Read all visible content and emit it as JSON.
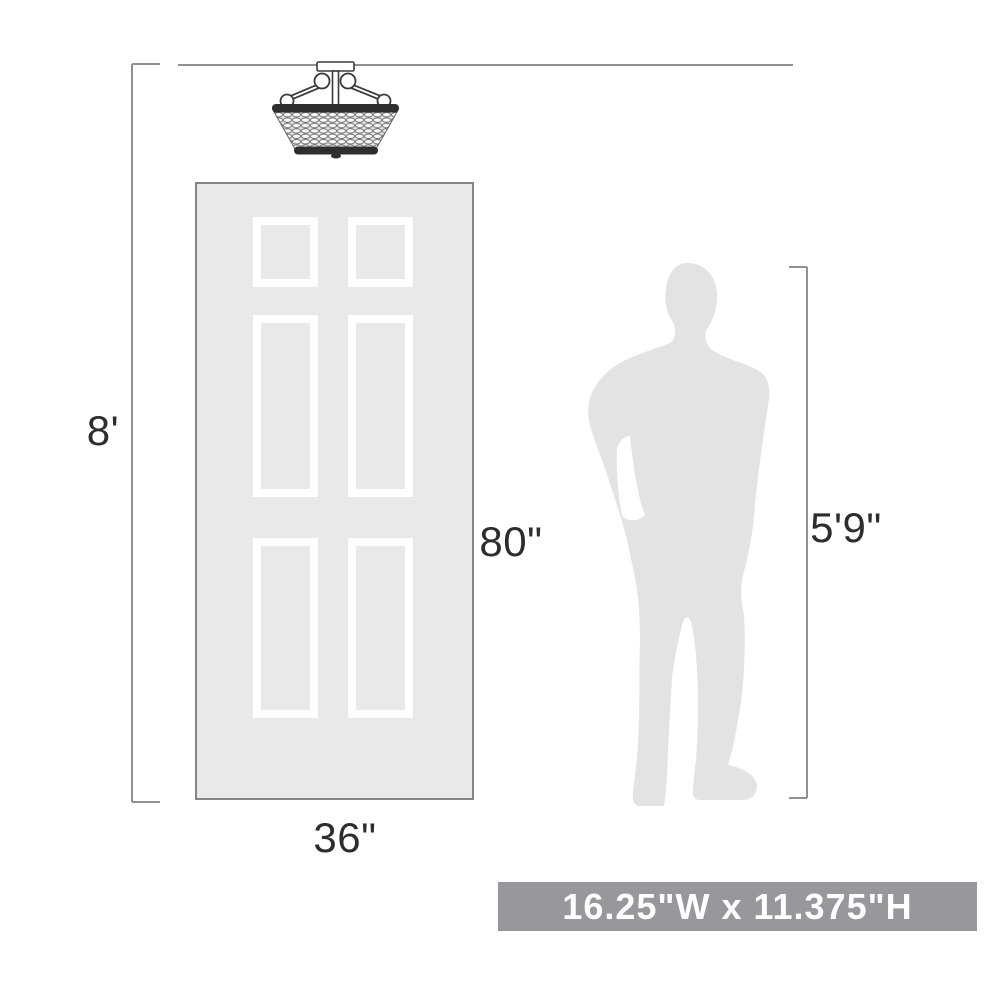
{
  "diagram": {
    "kind": "product-scale-diagram",
    "labels": {
      "ceiling_height": "8'",
      "door_height": "80\"",
      "door_width": "36\"",
      "person_height": "5'9\""
    },
    "banner": {
      "text": "16.25\"W x 11.375\"H",
      "bg_color": "#96989c",
      "text_color": "#ffffff"
    },
    "objects": {
      "fixture": "semi-flush-beaded-ceiling-light",
      "door": "six-panel-door",
      "person": "man-silhouette"
    },
    "colors": {
      "door_fill": "#e9e9e9",
      "door_border": "#858585",
      "panel_frame": "#ffffff",
      "silhouette_fill": "#e3e3e3",
      "dimension_line": "#909090",
      "label_text": "#2d2d2d",
      "fixture_dark": "#2e2e2e"
    }
  }
}
